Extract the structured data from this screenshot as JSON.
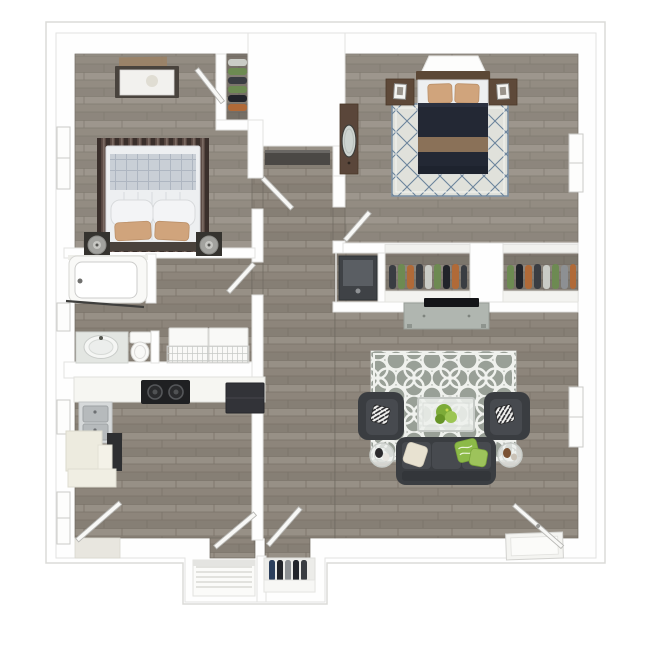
{
  "scene": {
    "view": "top-down 3D apartment floor plan render, no text labels",
    "rooms": [
      {
        "id": "bedroom-1",
        "items": [
          "wall-art",
          "dresser",
          "closet-hanging-clothes",
          "window",
          "striped-rug",
          "double-bed-white-bedding",
          "plaid-throw",
          "tan-accent-pillows",
          "nightstands",
          "table-lamps"
        ]
      },
      {
        "id": "bedroom-2",
        "items": [
          "wall-shelf",
          "headboard",
          "double-bed-navy-duvet",
          "tan-pillows",
          "nightstands-with-frames",
          "diamond-pattern-rug",
          "dresser-with-mirror",
          "window"
        ]
      },
      {
        "id": "hallway",
        "items": [
          "shelf-niche",
          "laundry-appliance-closet",
          "bedroom-doors",
          "bathroom-door"
        ]
      },
      {
        "id": "closet-row",
        "items": [
          "hanging-clothes-closet-1",
          "hanging-clothes-closet-2",
          "tv-console",
          "flat-screen-tv"
        ]
      },
      {
        "id": "bathroom",
        "items": [
          "bathtub",
          "shower-rod",
          "window",
          "vanity-sink",
          "toilet",
          "washer",
          "dryer",
          "wire-rack"
        ]
      },
      {
        "id": "kitchen",
        "items": [
          "countertop",
          "cooktop",
          "refrigerator",
          "double-sink",
          "oven",
          "cream-cabinets",
          "windows",
          "patio-door"
        ]
      },
      {
        "id": "living-room",
        "items": [
          "quatrefoil-rug",
          "armchairs",
          "striped-throw-pillows",
          "glass-coffee-table",
          "plant-centerpiece",
          "sofa",
          "cream-pillow",
          "green-pillows",
          "glass-end-tables",
          "figurines",
          "entry-door",
          "door-mat",
          "window"
        ]
      },
      {
        "id": "entry",
        "items": [
          "linen-closet-shelves",
          "coat-closet-hanging-clothes",
          "closet-doors"
        ]
      }
    ]
  },
  "palette": {
    "bg": "#ffffff",
    "platform-stroke": "#dbdbd8",
    "wall": "#fefefe",
    "wall-stroke": "#e2e2e0",
    "floor-plank-base": "#8d857b",
    "floor-plank-light": "#979086",
    "floor-plank-mid": "#867f75",
    "floor-plank-line": "#7a7369",
    "rug-bed2-base": "#e0e1db",
    "rug-bed2-line": "#6c849c",
    "rug-bed2-border": "#7d92a6",
    "rug-living-base": "#99a097",
    "rug-living-pattern": "#f0f2ee",
    "rug-stripe-dark": "#3a2f2b",
    "rug-stripe-mid": "#5d4c46",
    "rug-stripe-light": "#7a6a62",
    "bedding-white": "#edeff1",
    "bedding-stroke": "#d8dadd",
    "plaid-base": "#c9cfd6",
    "plaid-line": "#aeb6c1",
    "pillow-tan": "#d0a47c",
    "pillow-tan-stroke": "#bb9069",
    "duvet-navy": "#232834",
    "duvet-navy-light": "#2b3140",
    "duvet-band-brown": "#8a7158",
    "headboard-brown": "#5c4836",
    "wood-brown": "#5e4939",
    "wood-brown-stroke": "#4a3829",
    "furn-dark": "#35332f",
    "lamp-gray": "#a2a29e",
    "charcoal": "#3a3d41",
    "charcoal-light": "#474a4f",
    "charcoal-dark": "#33363a",
    "accent-green": "#8cba48",
    "accent-green-light": "#9dc35b",
    "cream": "#e8e2d1",
    "glass-fill": "#edf0ed",
    "glass-stroke": "#c7cbc7",
    "counter": "#f6f6f2",
    "cabinet-cream": "#edebdf",
    "stainless": "#d6d9da",
    "basin": "#b6babc",
    "stove-black": "#1f2022",
    "fridge-dark": "#323338",
    "appliance-dark": "#3f4246",
    "appliance-panel": "#5a5e63",
    "tv-black": "#141518",
    "tv-console": "#b0b6b0",
    "fixture-white": "#f9f9f7",
    "fixture-stroke": "#d6d6d3",
    "door-leaf": "#f8f8f6",
    "door-stroke": "#b8b8b5",
    "window-fill": "#fdfdfc",
    "window-stroke": "#cbcbc8",
    "shelf-dark": "#4b4845",
    "mirror": "#cdd4d0",
    "clothes-orange": "#b06a38",
    "clothes-green": "#6d8a52",
    "clothes-dark": "#3a3d42",
    "clothes-brown": "#7e552f",
    "clothes-white": "#caccc6",
    "clothes-navy": "#2c3f5c",
    "clothes-gray": "#8d9093",
    "clothes-black": "#22242a",
    "plant-green": "#7cab38",
    "plant-green-light": "#9cc553"
  }
}
